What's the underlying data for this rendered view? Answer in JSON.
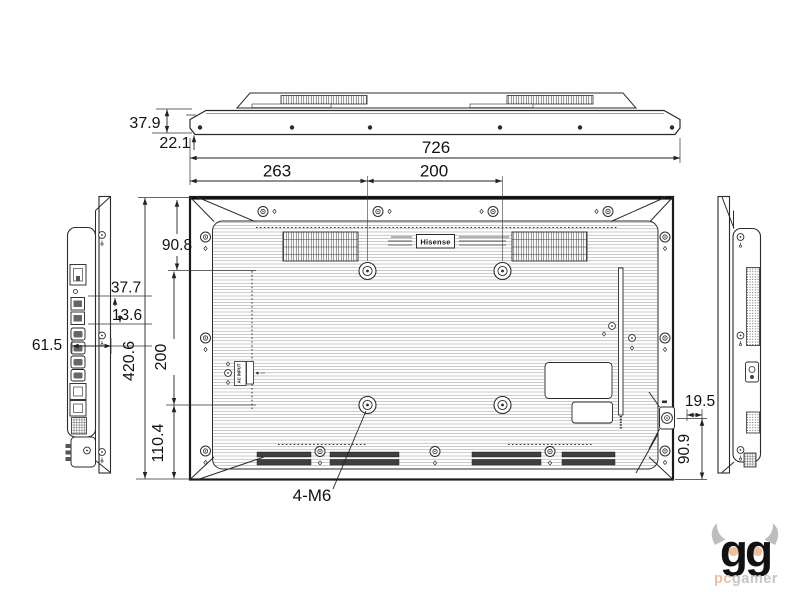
{
  "drawing": {
    "title": "Display rear-view dimensional drawing",
    "labels": {
      "brand": "Hisense",
      "ac_input": "AC INPUT"
    },
    "dims": {
      "top_depth_total": "37.9",
      "top_depth_front": "22.1",
      "width_total": "726",
      "left_to_vesa": "263",
      "vesa_width": "200",
      "top_to_vesa": "90.8",
      "port_offset_a": "37.7",
      "port_offset_b": "13.6",
      "side_depth": "61.5",
      "height_total": "420.6",
      "vesa_height": "200",
      "vesa_to_bottom": "110.4",
      "power_offset": "19.5",
      "power_to_bottom": "90.9",
      "vesa_thread_callout": "4-M6"
    }
  },
  "watermark": {
    "gg": "gg",
    "pc": "pc",
    "gamer": "gamer"
  },
  "colors": {
    "line": "#2b2b2b",
    "speaker_fill": "#3f3f3f",
    "watermark_gray": "#c6c6c6",
    "watermark_accent": "#ecbfa0"
  }
}
